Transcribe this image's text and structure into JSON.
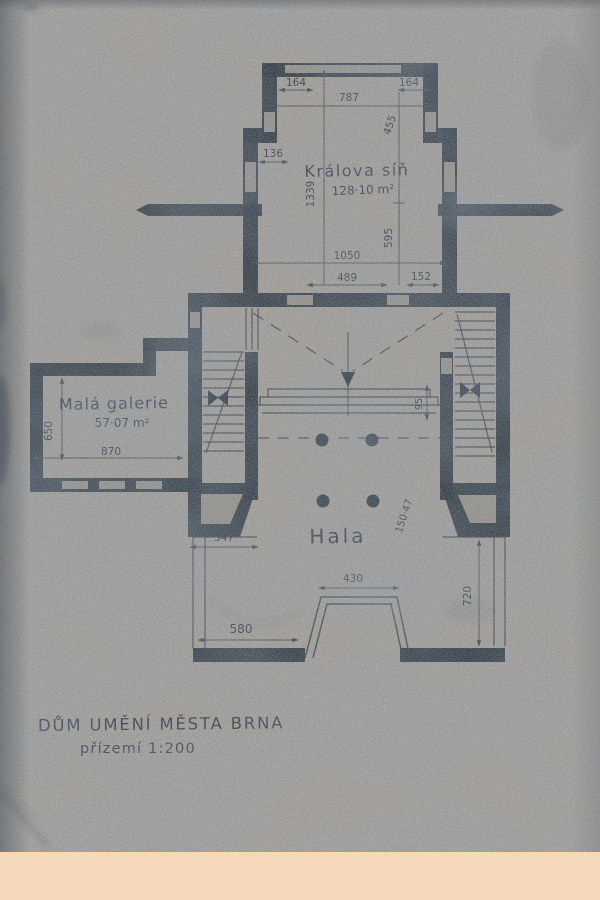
{
  "drawing": {
    "title": "DŮM UMĚNÍ MĚSTA BRNA",
    "scale_line": "přízemí 1:200"
  },
  "rooms": {
    "kralova_sin": {
      "name": "Králova síň",
      "area": "128·10 m²"
    },
    "mala_galerie": {
      "name": "Malá galerie",
      "area": "57·07 m²"
    },
    "hala": {
      "name": "Hala"
    }
  },
  "dims": {
    "bay_left": "164",
    "bay_width": "787",
    "bay_right": "164",
    "bay_height": "455",
    "sin_window": "136",
    "sin_length": "1339",
    "sin_lower_height": "595",
    "sin_width": "1050",
    "sin_door_span": "489",
    "sin_right_offset": "152",
    "galerie_height": "650",
    "galerie_width": "870",
    "hala_left": "347",
    "steps_depth": "95",
    "hala_note": "150·47",
    "entry_width": "430",
    "south_left": "580",
    "south_height": "720"
  },
  "colors": {
    "paper": "#a8a29a",
    "ink": "#27313b",
    "pencil": "#3b4651",
    "bottom_band": "#f6d9ba"
  }
}
